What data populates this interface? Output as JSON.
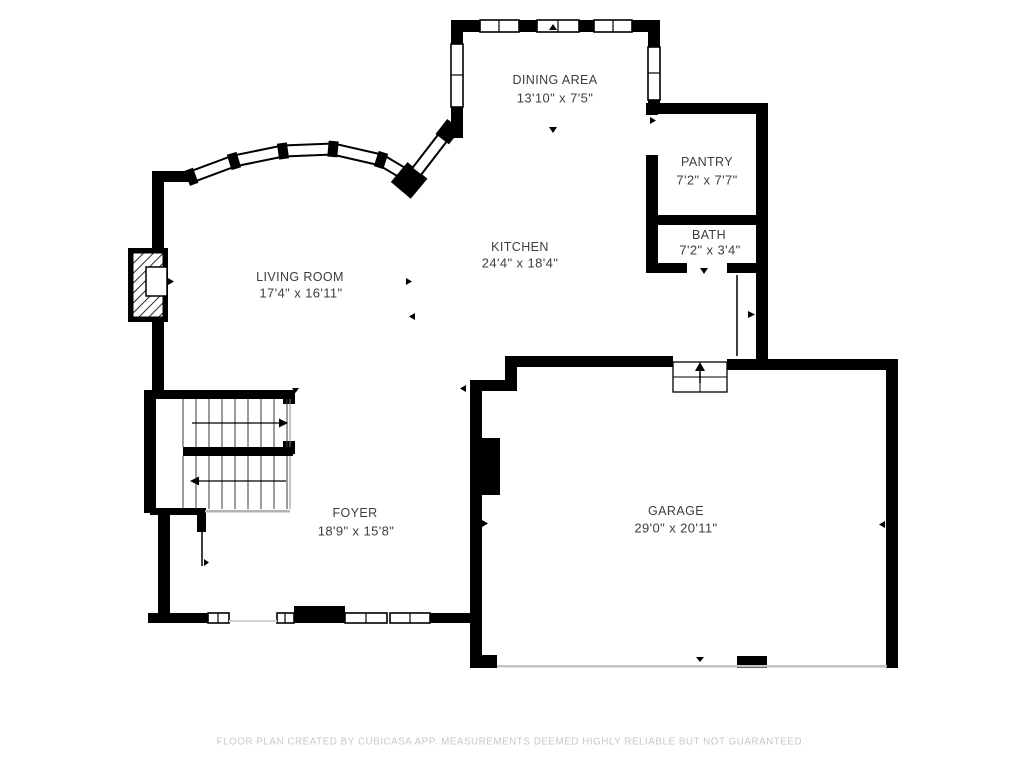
{
  "colors": {
    "wall": "#000000",
    "label_text": "#3b3e41",
    "footer_text": "#c6c8ca",
    "light_line": "#c2c2c2"
  },
  "rooms": [
    {
      "name": "DINING AREA",
      "dims": "13'10\" x 7'5\""
    },
    {
      "name": "PANTRY",
      "dims": "7'2\" x 7'7\""
    },
    {
      "name": "BATH",
      "dims": "7'2\" x 3'4\""
    },
    {
      "name": "KITCHEN",
      "dims": "24'4\" x 18'4\""
    },
    {
      "name": "LIVING ROOM",
      "dims": "17'4\" x 16'11\""
    },
    {
      "name": "FOYER",
      "dims": "18'9\" x 15'8\""
    },
    {
      "name": "GARAGE",
      "dims": "29'0\" x 20'11\""
    }
  ],
  "footer": {
    "disclaimer": "FLOOR PLAN CREATED BY CUBICASA APP. MEASUREMENTS DEEMED HIGHLY RELIABLE BUT NOT GUARANTEED."
  }
}
